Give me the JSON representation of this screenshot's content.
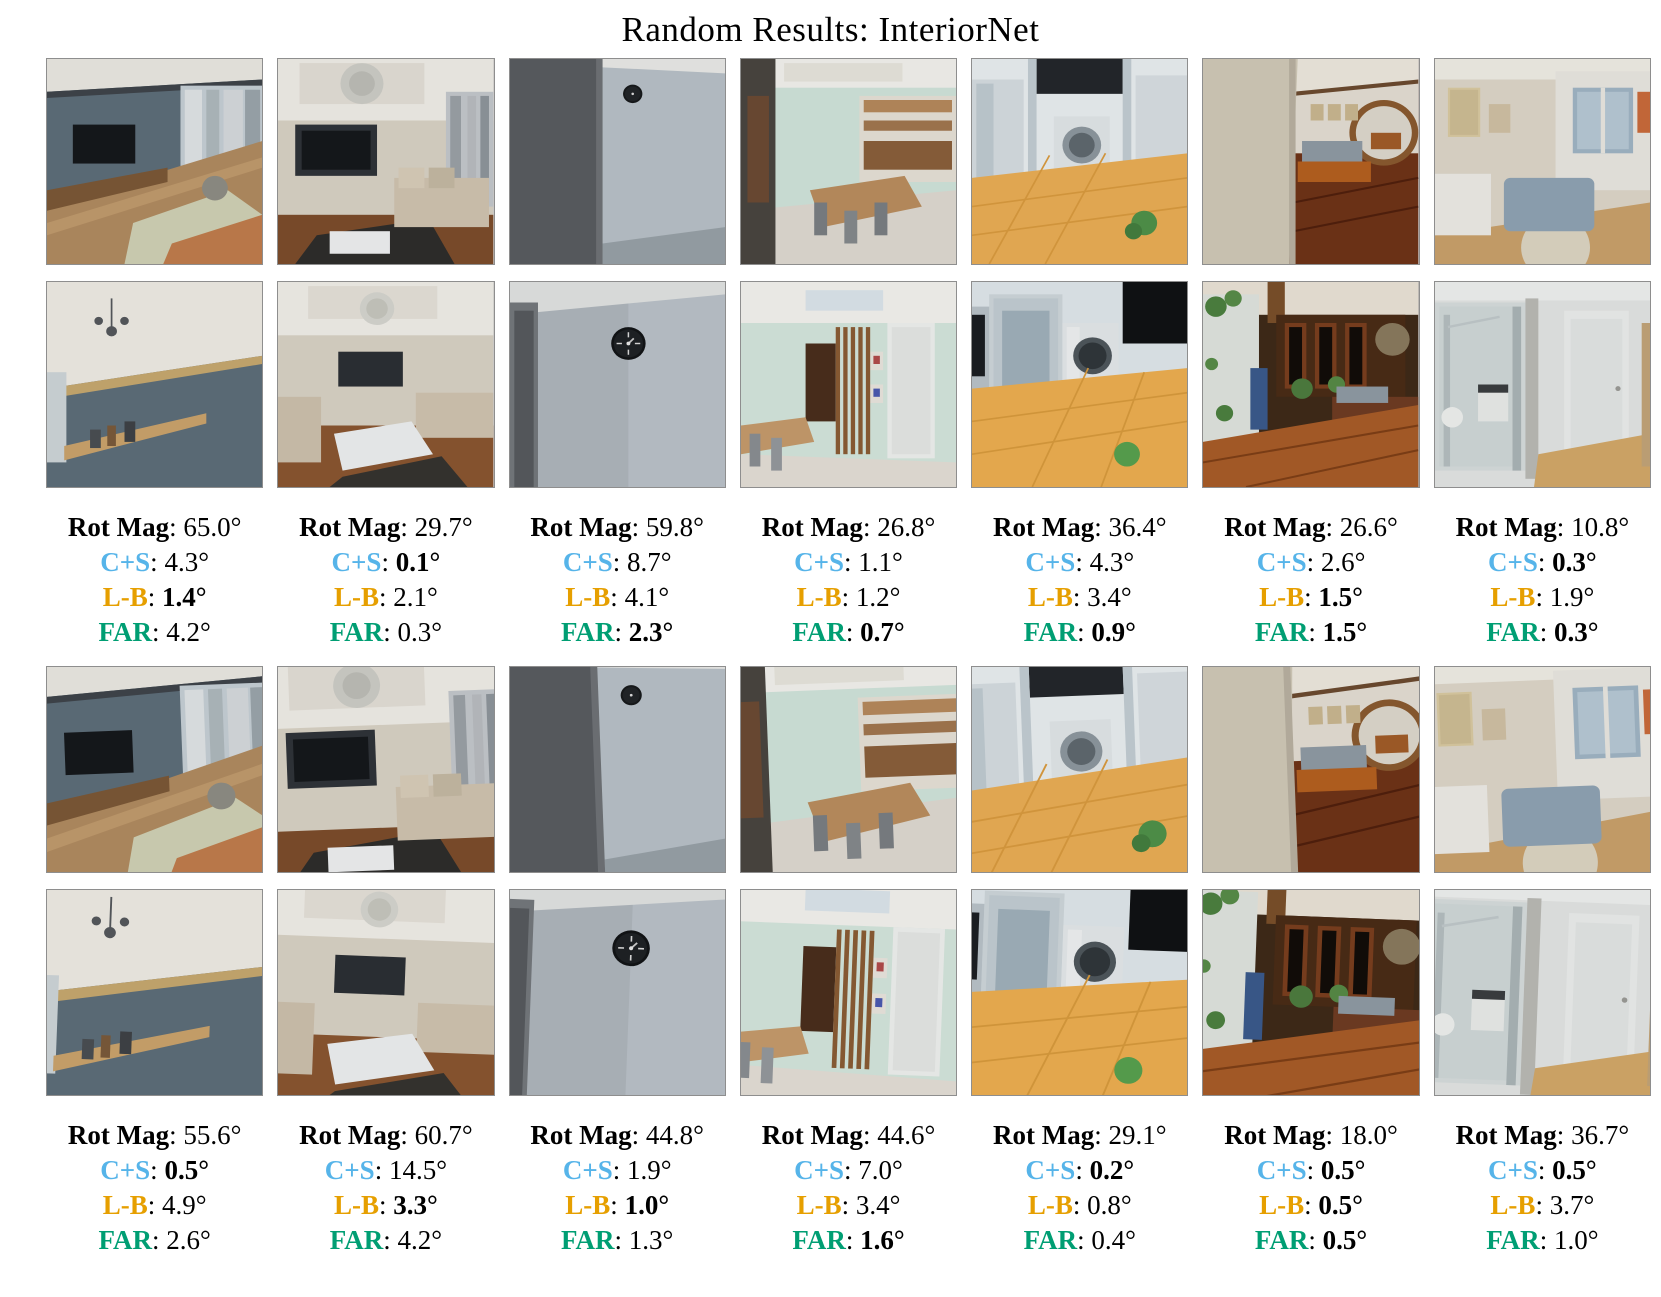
{
  "title": "Random Results: InteriorNet",
  "colors": {
    "rot_mag": "#000000",
    "cs": "#56B4E9",
    "lb": "#E69F00",
    "far": "#009E73"
  },
  "columns": [
    {
      "scene": "living-room-blue-gray-tv",
      "block1": {
        "rows": [
          {
            "key": "rot_mag",
            "label": "Rot Mag",
            "value": "65.0°",
            "bold": false
          },
          {
            "key": "cs",
            "label": "C+S",
            "value": "4.3°",
            "bold": false
          },
          {
            "key": "lb",
            "label": "L-B",
            "value": "1.4°",
            "bold": true
          },
          {
            "key": "far",
            "label": "FAR",
            "value": "4.2°",
            "bold": false
          }
        ]
      },
      "block2": {
        "rows": [
          {
            "key": "rot_mag",
            "label": "Rot Mag",
            "value": "55.6°",
            "bold": false
          },
          {
            "key": "cs",
            "label": "C+S",
            "value": "0.5°",
            "bold": true
          },
          {
            "key": "lb",
            "label": "L-B",
            "value": "4.9°",
            "bold": false
          },
          {
            "key": "far",
            "label": "FAR",
            "value": "2.6°",
            "bold": false
          }
        ]
      }
    },
    {
      "scene": "classic-living-room-chandelier",
      "block1": {
        "rows": [
          {
            "key": "rot_mag",
            "label": "Rot Mag",
            "value": "29.7°",
            "bold": false
          },
          {
            "key": "cs",
            "label": "C+S",
            "value": "0.1°",
            "bold": true
          },
          {
            "key": "lb",
            "label": "L-B",
            "value": "2.1°",
            "bold": false
          },
          {
            "key": "far",
            "label": "FAR",
            "value": "0.3°",
            "bold": false
          }
        ]
      },
      "block2": {
        "rows": [
          {
            "key": "rot_mag",
            "label": "Rot Mag",
            "value": "60.7°",
            "bold": false
          },
          {
            "key": "cs",
            "label": "C+S",
            "value": "14.5°",
            "bold": false
          },
          {
            "key": "lb",
            "label": "L-B",
            "value": "3.3°",
            "bold": true
          },
          {
            "key": "far",
            "label": "FAR",
            "value": "4.2°",
            "bold": false
          }
        ]
      }
    },
    {
      "scene": "gray-wall-corner-clock",
      "block1": {
        "rows": [
          {
            "key": "rot_mag",
            "label": "Rot Mag",
            "value": "59.8°",
            "bold": false
          },
          {
            "key": "cs",
            "label": "C+S",
            "value": "8.7°",
            "bold": false
          },
          {
            "key": "lb",
            "label": "L-B",
            "value": "4.1°",
            "bold": false
          },
          {
            "key": "far",
            "label": "FAR",
            "value": "2.3°",
            "bold": true
          }
        ]
      },
      "block2": {
        "rows": [
          {
            "key": "rot_mag",
            "label": "Rot Mag",
            "value": "44.8°",
            "bold": false
          },
          {
            "key": "cs",
            "label": "C+S",
            "value": "1.9°",
            "bold": false
          },
          {
            "key": "lb",
            "label": "L-B",
            "value": "1.0°",
            "bold": true
          },
          {
            "key": "far",
            "label": "FAR",
            "value": "1.3°",
            "bold": false
          }
        ]
      }
    },
    {
      "scene": "mint-dining-room",
      "block1": {
        "rows": [
          {
            "key": "rot_mag",
            "label": "Rot Mag",
            "value": "26.8°",
            "bold": false
          },
          {
            "key": "cs",
            "label": "C+S",
            "value": "1.1°",
            "bold": false
          },
          {
            "key": "lb",
            "label": "L-B",
            "value": "1.2°",
            "bold": false
          },
          {
            "key": "far",
            "label": "FAR",
            "value": "0.7°",
            "bold": true
          }
        ]
      },
      "block2": {
        "rows": [
          {
            "key": "rot_mag",
            "label": "Rot Mag",
            "value": "44.6°",
            "bold": false
          },
          {
            "key": "cs",
            "label": "C+S",
            "value": "7.0°",
            "bold": false
          },
          {
            "key": "lb",
            "label": "L-B",
            "value": "3.4°",
            "bold": false
          },
          {
            "key": "far",
            "label": "FAR",
            "value": "1.6°",
            "bold": true
          }
        ]
      }
    },
    {
      "scene": "laundry-balcony-orange-tile",
      "block1": {
        "rows": [
          {
            "key": "rot_mag",
            "label": "Rot Mag",
            "value": "36.4°",
            "bold": false
          },
          {
            "key": "cs",
            "label": "C+S",
            "value": "4.3°",
            "bold": false
          },
          {
            "key": "lb",
            "label": "L-B",
            "value": "3.4°",
            "bold": false
          },
          {
            "key": "far",
            "label": "FAR",
            "value": "0.9°",
            "bold": true
          }
        ]
      },
      "block2": {
        "rows": [
          {
            "key": "rot_mag",
            "label": "Rot Mag",
            "value": "29.1°",
            "bold": false
          },
          {
            "key": "cs",
            "label": "C+S",
            "value": "0.2°",
            "bold": true
          },
          {
            "key": "lb",
            "label": "L-B",
            "value": "0.8°",
            "bold": false
          },
          {
            "key": "far",
            "label": "FAR",
            "value": "0.4°",
            "bold": false
          }
        ]
      }
    },
    {
      "scene": "wood-floor-chinese-living-room",
      "block1": {
        "rows": [
          {
            "key": "rot_mag",
            "label": "Rot Mag",
            "value": "26.6°",
            "bold": false
          },
          {
            "key": "cs",
            "label": "C+S",
            "value": "2.6°",
            "bold": false
          },
          {
            "key": "lb",
            "label": "L-B",
            "value": "1.5°",
            "bold": true
          },
          {
            "key": "far",
            "label": "FAR",
            "value": "1.5°",
            "bold": true
          }
        ]
      },
      "block2": {
        "rows": [
          {
            "key": "rot_mag",
            "label": "Rot Mag",
            "value": "18.0°",
            "bold": false
          },
          {
            "key": "cs",
            "label": "C+S",
            "value": "0.5°",
            "bold": true
          },
          {
            "key": "lb",
            "label": "L-B",
            "value": "0.5°",
            "bold": true
          },
          {
            "key": "far",
            "label": "FAR",
            "value": "0.5°",
            "bold": true
          }
        ]
      }
    },
    {
      "scene": "bedroom-wardrobe-and-bathroom",
      "block1": {
        "rows": [
          {
            "key": "rot_mag",
            "label": "Rot Mag",
            "value": "10.8°",
            "bold": false
          },
          {
            "key": "cs",
            "label": "C+S",
            "value": "0.3°",
            "bold": true
          },
          {
            "key": "lb",
            "label": "L-B",
            "value": "1.9°",
            "bold": false
          },
          {
            "key": "far",
            "label": "FAR",
            "value": "0.3°",
            "bold": true
          }
        ]
      },
      "block2": {
        "rows": [
          {
            "key": "rot_mag",
            "label": "Rot Mag",
            "value": "36.7°",
            "bold": false
          },
          {
            "key": "cs",
            "label": "C+S",
            "value": "0.5°",
            "bold": true
          },
          {
            "key": "lb",
            "label": "L-B",
            "value": "3.7°",
            "bold": false
          },
          {
            "key": "far",
            "label": "FAR",
            "value": "1.0°",
            "bold": false
          }
        ]
      }
    }
  ]
}
